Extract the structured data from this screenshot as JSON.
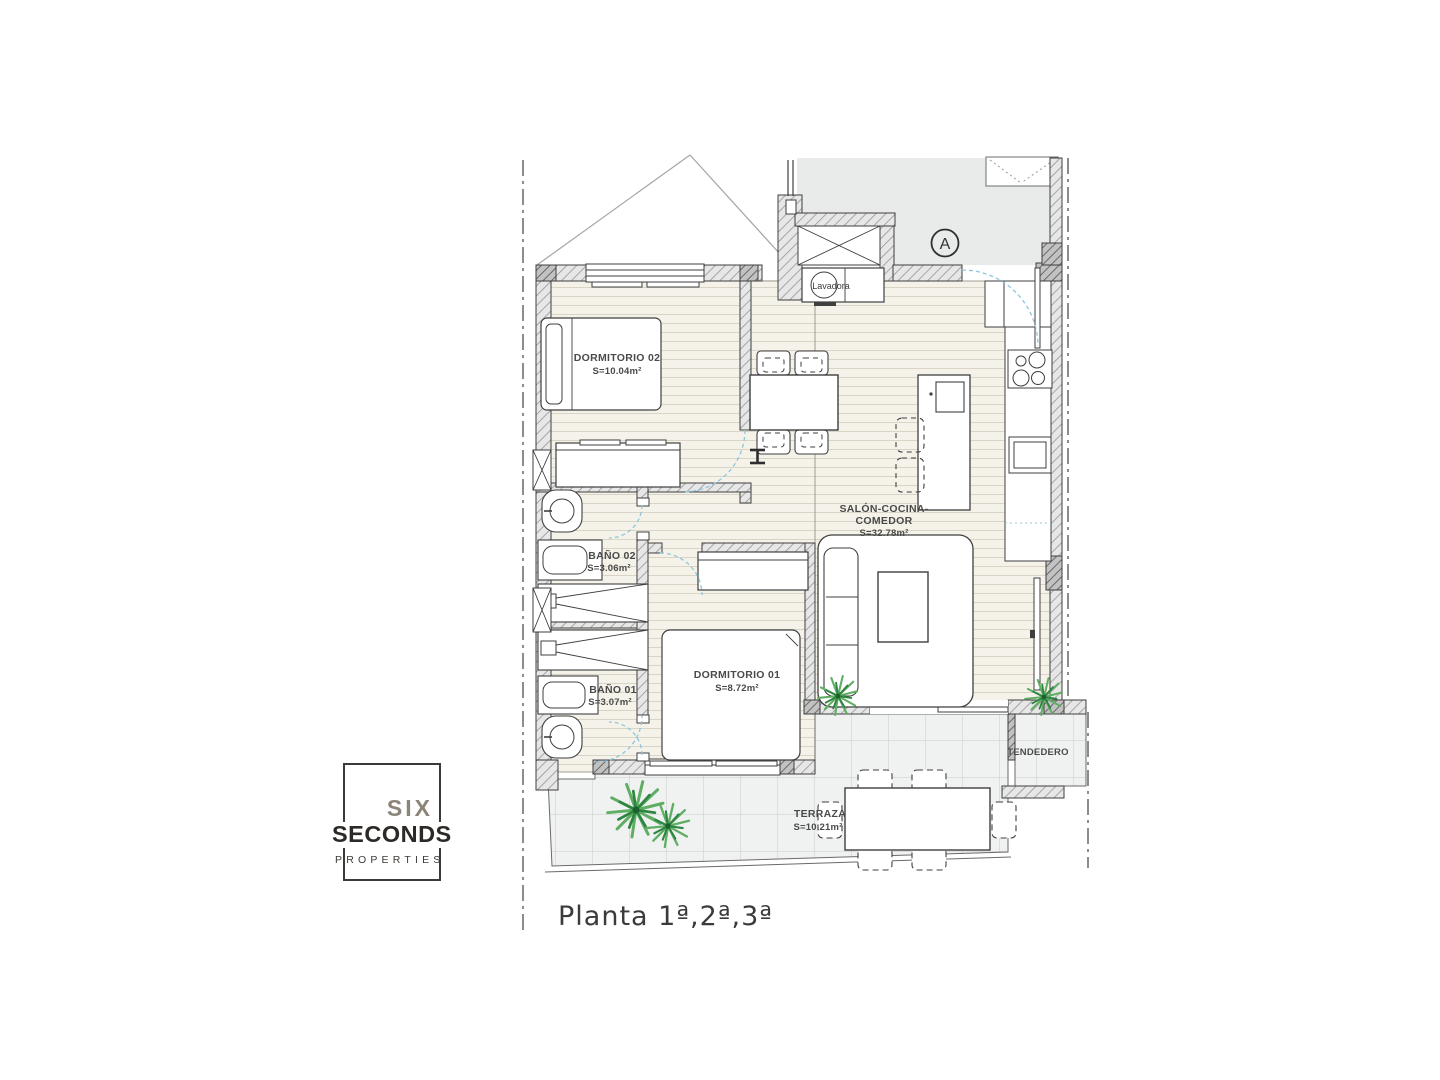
{
  "plan": {
    "section_marker": "A",
    "labels": {
      "dormitorio02_name": "DORMITORIO 02",
      "dormitorio02_area": "S=10.04m²",
      "salon_name1": "SALÓN-COCINA-",
      "salon_name2": "COMEDOR",
      "salon_area": "S=32.78m²",
      "dormitorio01_name": "DORMITORIO 01",
      "dormitorio01_area": "S=8.72m²",
      "bano02_name": "BAÑO 02",
      "bano02_area": "S=3.06m²",
      "bano01_name": "BAÑO 01",
      "bano01_area": "S=3.07m²",
      "terraza_name": "TERRAZA",
      "terraza_area": "S=10.21m²",
      "tendedero_name": "TENDEDERO",
      "lavadora_label": "Lavadora"
    }
  },
  "branding": {
    "word1": "SIX",
    "word2": "SECONDS",
    "word3": "PROPERTIES"
  },
  "caption": {
    "title": "Planta 1ª,2ª,3ª"
  },
  "colors": {
    "door_arc": "#8fc6dc",
    "plant_green": "#3f9a4f",
    "wall_outline": "#3f3f3f"
  }
}
